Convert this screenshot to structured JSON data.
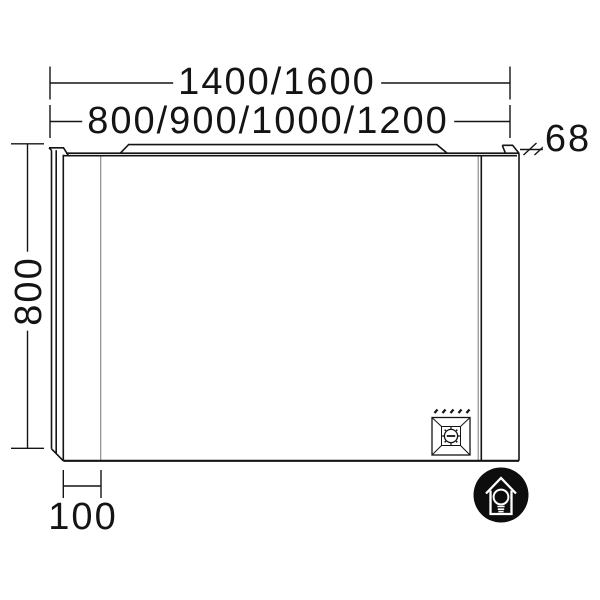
{
  "drawing": {
    "type": "technical-dimension-diagram",
    "subject": "mirror with LED light strip and side panels",
    "dimension_labels": {
      "overall_width": "1400/1600",
      "mirror_width": "800/900/1000/1200",
      "depth": "68",
      "height": "800",
      "side_panel_width": "100"
    },
    "icons": {
      "socket": "power-socket-icon",
      "badge": "house-lightbulb-icon"
    }
  },
  "colors": {
    "line": "#141414",
    "thin_line": "#8c8c8c",
    "background": "#ffffff",
    "badge_bg": "#0d0d0d"
  }
}
